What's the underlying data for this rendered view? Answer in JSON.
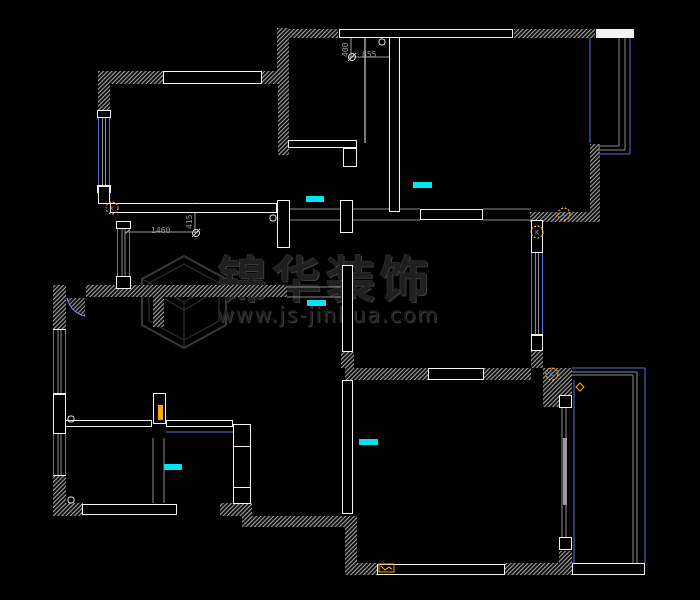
{
  "app": {
    "type": "cad-floorplan-screenshot",
    "background": "#000000"
  },
  "palette": {
    "wall_white": "#f2f2f2",
    "hatch_gray": "#a9a9a9",
    "line_gray": "#8c8c8c",
    "dim_gray": "#9a9a9a",
    "window_blue": "#5b6ee1",
    "arc_blue": "#7b8de8",
    "marker_cyan": "#00e6f0",
    "marker_orange": "#ffa500",
    "watermark_gray": "#3c3c3c"
  },
  "watermark": {
    "title": "锦华装饰",
    "url": "www.js-jinhua.com",
    "logo": "isometric-cube"
  },
  "dimension_labels": [
    {
      "text": "1460",
      "x": 151,
      "y": 233,
      "rot": 0
    },
    {
      "text": "415",
      "x": 192,
      "y": 229,
      "rot": -90
    },
    {
      "text": "855",
      "x": 362,
      "y": 57,
      "rot": 0
    },
    {
      "text": "400",
      "x": 348,
      "y": 57,
      "rot": -90
    }
  ],
  "floorplan": {
    "hatch_walls": [
      [
        98,
        71,
        65,
        13
      ],
      [
        262,
        71,
        23,
        13
      ],
      [
        98,
        84,
        12,
        33
      ],
      [
        277,
        28,
        12,
        52
      ],
      [
        278,
        80,
        11,
        75
      ],
      [
        280,
        29,
        58,
        9
      ],
      [
        514,
        29,
        81,
        9
      ],
      [
        590,
        144,
        10,
        68
      ],
      [
        530,
        212,
        70,
        10
      ],
      [
        531,
        350,
        12,
        18
      ],
      [
        543,
        368,
        29,
        39
      ],
      [
        345,
        368,
        83,
        12
      ],
      [
        484,
        368,
        47,
        12
      ],
      [
        341,
        352,
        13,
        16
      ],
      [
        53,
        285,
        13,
        44
      ],
      [
        86,
        285,
        76,
        12
      ],
      [
        162,
        285,
        125,
        12
      ],
      [
        153,
        297,
        11,
        30
      ],
      [
        53,
        476,
        13,
        40
      ],
      [
        53,
        503,
        30,
        13
      ],
      [
        220,
        503,
        32,
        13
      ],
      [
        242,
        516,
        115,
        11
      ],
      [
        345,
        525,
        12,
        50
      ],
      [
        345,
        563,
        32,
        12
      ],
      [
        505,
        563,
        67,
        12
      ],
      [
        559,
        551,
        13,
        24
      ]
    ],
    "outline_walls": [
      [
        163,
        71,
        99,
        13
      ],
      [
        339,
        29,
        174,
        9
      ],
      [
        428,
        368,
        56,
        12
      ],
      [
        420,
        209,
        63,
        11
      ],
      [
        82,
        504,
        95,
        11
      ],
      [
        377,
        564,
        128,
        11
      ],
      [
        572,
        563,
        73,
        12
      ],
      [
        277,
        200,
        13,
        48
      ],
      [
        340,
        200,
        13,
        33
      ],
      [
        342,
        265,
        11,
        87
      ],
      [
        559,
        395,
        13,
        13
      ],
      [
        559,
        537,
        13,
        13
      ],
      [
        65,
        420,
        87,
        7
      ],
      [
        153,
        393,
        13,
        31
      ],
      [
        97,
        110,
        14,
        8
      ],
      [
        97,
        185,
        14,
        8
      ],
      [
        116,
        221,
        15,
        8
      ],
      [
        116,
        276,
        15,
        13
      ],
      [
        98,
        186,
        12,
        18
      ],
      [
        531,
        220,
        12,
        33
      ],
      [
        531,
        335,
        12,
        16
      ],
      [
        233,
        424,
        18,
        23
      ],
      [
        233,
        487,
        18,
        17
      ],
      [
        53,
        394,
        13,
        40
      ],
      [
        342,
        380,
        11,
        134
      ],
      [
        110,
        203,
        167,
        10
      ],
      [
        288,
        140,
        69,
        8
      ],
      [
        343,
        148,
        14,
        19
      ],
      [
        389,
        37,
        11,
        175
      ],
      [
        166,
        420,
        67,
        7
      ],
      [
        233,
        446,
        18,
        42
      ]
    ],
    "filled_walls": [
      [
        596,
        29,
        38,
        9
      ]
    ],
    "lines": [
      [
        290,
        209,
        420,
        209,
        "g"
      ],
      [
        290,
        220,
        420,
        220,
        "g"
      ],
      [
        483,
        209,
        531,
        209,
        "g"
      ],
      [
        483,
        220,
        531,
        220,
        "g"
      ],
      [
        287,
        287,
        341,
        287,
        "g"
      ],
      [
        287,
        297,
        341,
        297,
        "g"
      ],
      [
        153,
        438,
        153,
        503,
        "g"
      ],
      [
        164,
        438,
        164,
        503,
        "g"
      ],
      [
        619,
        38,
        619,
        146,
        "g"
      ],
      [
        625,
        38,
        625,
        150,
        "g"
      ],
      [
        598,
        146,
        619,
        146,
        "g"
      ],
      [
        598,
        150,
        625,
        150,
        "g"
      ],
      [
        572,
        372,
        637,
        372,
        "g"
      ],
      [
        572,
        375,
        633,
        375,
        "g"
      ],
      [
        637,
        372,
        637,
        563,
        "g"
      ],
      [
        633,
        375,
        633,
        563,
        "g"
      ],
      [
        562,
        408,
        562,
        537,
        "g"
      ],
      [
        566,
        408,
        566,
        537,
        "g"
      ],
      [
        349,
        57,
        392,
        57,
        "d"
      ],
      [
        351,
        38,
        351,
        57,
        "d"
      ],
      [
        125,
        232,
        198,
        232,
        "d"
      ],
      [
        195,
        205,
        195,
        233,
        "d"
      ],
      [
        390,
        59,
        394,
        55,
        "d"
      ],
      [
        125,
        234,
        129,
        230,
        "d"
      ],
      [
        193,
        207,
        197,
        203,
        "d"
      ],
      [
        590,
        38,
        590,
        143,
        "b"
      ],
      [
        630,
        38,
        630,
        154,
        "b"
      ],
      [
        598,
        154,
        630,
        154,
        "b"
      ],
      [
        572,
        368,
        645,
        368,
        "b"
      ],
      [
        645,
        368,
        645,
        563,
        "b"
      ],
      [
        574,
        380,
        574,
        563,
        "b"
      ],
      [
        166,
        432,
        233,
        432,
        "b"
      ],
      [
        235,
        447,
        235,
        487,
        "b"
      ],
      [
        249,
        447,
        249,
        487,
        "b"
      ],
      [
        365,
        38,
        365,
        143,
        "w"
      ]
    ],
    "windows": [
      [
        98,
        117,
        12,
        69
      ],
      [
        117,
        228,
        13,
        49
      ],
      [
        53,
        329,
        13,
        65
      ],
      [
        53,
        433,
        13,
        43
      ],
      [
        531,
        252,
        12,
        83
      ]
    ],
    "cyan_markers": [
      [
        306,
        196,
        18,
        6
      ],
      [
        413,
        182,
        19,
        6
      ],
      [
        307,
        300,
        19,
        6
      ],
      [
        359,
        439,
        19,
        6
      ],
      [
        164,
        464,
        18,
        6
      ]
    ],
    "white_circles": [
      [
        273,
        218
      ],
      [
        382,
        42
      ],
      [
        71,
        419
      ],
      [
        71,
        500
      ]
    ],
    "dim_end_circles": [
      [
        196,
        233
      ],
      [
        352,
        57
      ]
    ],
    "k_markers": {
      "label": "K",
      "positions": [
        [
          112,
          208
        ],
        [
          564,
          214
        ],
        [
          537,
          232
        ],
        [
          552,
          374
        ]
      ]
    },
    "diamond_marker": [
      580,
      387
    ],
    "door_leaf_orange": [
      158,
      405,
      5,
      15
    ],
    "appliance_marker": [
      379,
      564,
      15,
      8
    ],
    "sliding_door_leaf": [
      563,
      438,
      4,
      67
    ],
    "door_swing": {
      "wedge": "M 67 298 L 85 298 L 85 316 Q 70 312 67 298 Z",
      "arc": "M 67 298 Q 71 313 85 316"
    }
  }
}
